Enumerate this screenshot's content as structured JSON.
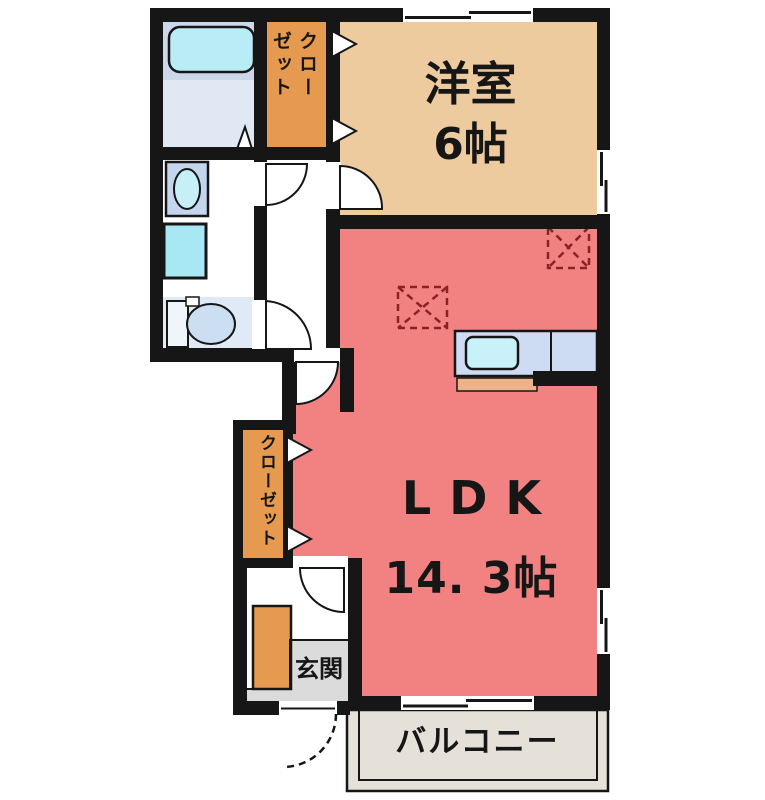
{
  "floor_plan": {
    "western_room": {
      "name": "洋室",
      "size": "6帖"
    },
    "ldk": {
      "name": "LDK",
      "size": "14. 3帖"
    },
    "balcony": {
      "name": "バルコニー"
    },
    "entrance": {
      "name": "玄関"
    },
    "upper_closet": {
      "column_right": "クロー",
      "column_left": "ゼット"
    },
    "lower_closet": {
      "name": "クローゼット"
    },
    "fixtures": [
      "bathtub-icon",
      "washbasin-icon",
      "washing-machine-icon",
      "toilet-icon",
      "kitchen-counter-icon",
      "kitchen-sink-icon",
      "shoe-cabinet-icon",
      "refrigerator-space-icon",
      "appliance-space-icon"
    ],
    "colors": {
      "wall": "#161616",
      "ldk_floor": "#f28282",
      "western_room_floor": "#eeca9f",
      "closet": "#e69a4f",
      "bath_floor": "#dfe8f3",
      "bathtub": "#baecf6",
      "washing_machine": "#a8e8f4",
      "balcony_floor": "#e5e0d8",
      "genkan_floor": "#dbdbdb",
      "kitchen_counter": "#cddcf2",
      "appliance_dash": "#8b2222"
    }
  }
}
